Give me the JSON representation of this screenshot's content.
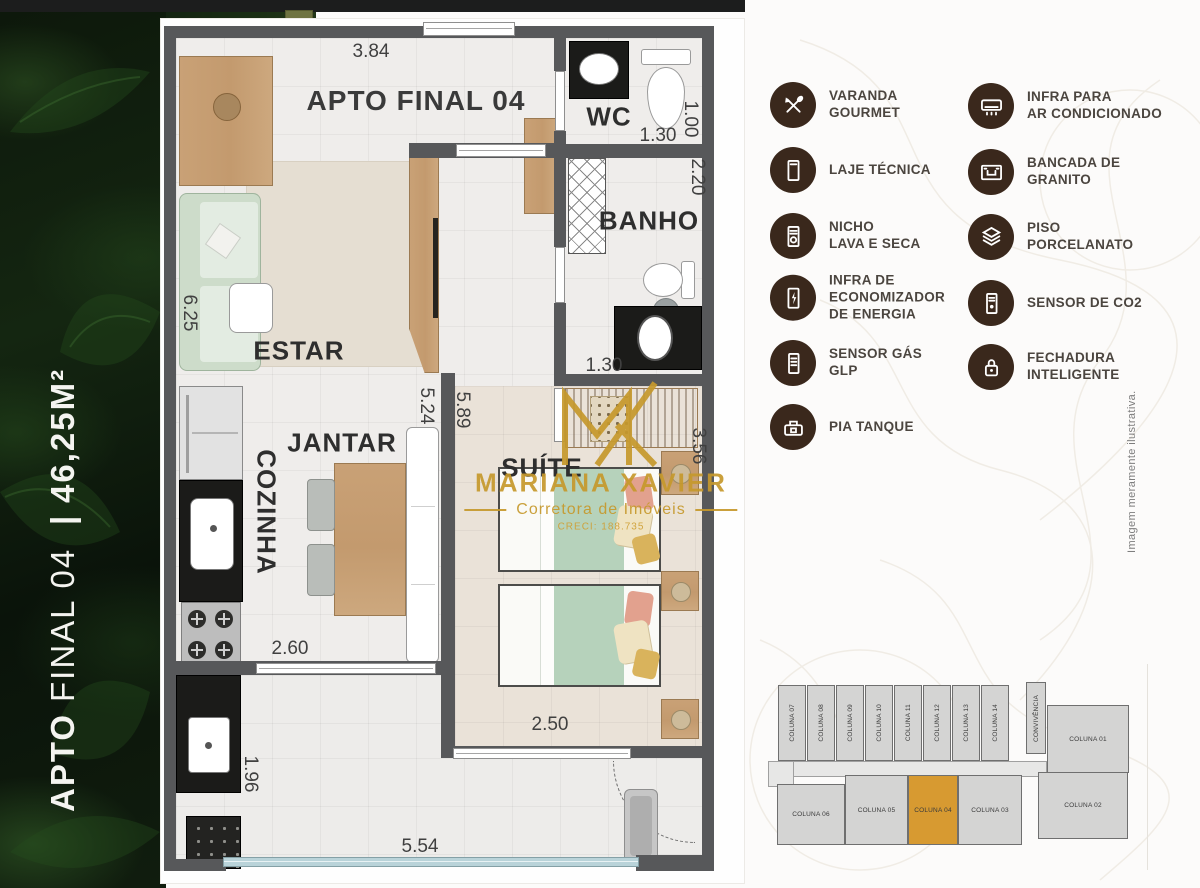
{
  "left_panel": {
    "apto": "APTO",
    "final": "FINAL 04",
    "separator": "|",
    "area": "46,25M²"
  },
  "floorplan": {
    "title": "APTO FINAL 04",
    "rooms": {
      "estar": "ESTAR",
      "jantar": "JANTAR",
      "cozinha": "COZINHA",
      "wc": "WC",
      "banho": "BANHO",
      "suite": "SUÍTE"
    },
    "dimensions": {
      "top_width": "3.84",
      "wc_width": "1.30",
      "wc_height": "1.00",
      "banho_height": "2.20",
      "banho_width": "1.30",
      "estar_height": "6.25",
      "divider_left": "5.24",
      "divider_right": "5.89",
      "suite_height": "3.56",
      "cozinha_width": "2.60",
      "suite_width": "2.50",
      "varanda_height": "1.96",
      "bottom_width": "5.54"
    }
  },
  "watermark": {
    "name": "MARIANA XAVIER",
    "subtitle": "Corretora de Imóveis",
    "creci": "CRECI: 188.735"
  },
  "legend": {
    "columns": [
      {
        "items": [
          {
            "icon": "varanda-gourmet-icon",
            "lines": [
              "VARANDA",
              "GOURMET"
            ]
          },
          {
            "icon": "laje-tecnica-icon",
            "lines": [
              "LAJE TÉCNICA"
            ]
          },
          {
            "icon": "nicho-lava-seca-icon",
            "lines": [
              "NICHO",
              "LAVA E SECA"
            ]
          },
          {
            "icon": "economizador-energia-icon",
            "lines": [
              "INFRA DE",
              "ECONOMIZADOR",
              "DE ENERGIA"
            ]
          },
          {
            "icon": "sensor-gas-glp-icon",
            "lines": [
              "SENSOR GÁS",
              "GLP"
            ]
          },
          {
            "icon": "pia-tanque-icon",
            "lines": [
              "PIA TANQUE"
            ]
          }
        ]
      },
      {
        "items": [
          {
            "icon": "ar-condicionado-icon",
            "lines": [
              "INFRA PARA",
              "AR CONDICIONADO"
            ]
          },
          {
            "icon": "bancada-granito-icon",
            "lines": [
              "BANCADA DE",
              "GRANITO"
            ]
          },
          {
            "icon": "piso-porcelanato-icon",
            "lines": [
              "PISO",
              "PORCELANATO"
            ]
          },
          {
            "icon": "sensor-co2-icon",
            "lines": [
              "SENSOR DE CO2"
            ]
          },
          {
            "icon": "fechadura-inteligente-icon",
            "lines": [
              "FECHADURA",
              "INTELIGENTE"
            ]
          }
        ]
      }
    ]
  },
  "disclaimer": "Imagem meramente ilustrativa.",
  "building_key": {
    "vertical_units": [
      "COLUNA 07",
      "COLUNA 08",
      "COLUNA 09",
      "COLUNA 10",
      "COLUNA 11",
      "COLUNA 12",
      "COLUNA 13",
      "COLUNA 14"
    ],
    "convivencia": "CONVIVÊNCIA",
    "right_top_unit": "COLUNA 01",
    "bottom_units": [
      "COLUNA 06",
      "COLUNA 05",
      "COLUNA 04",
      "COLUNA 03"
    ],
    "right_bottom_unit": "COLUNA 02",
    "highlighted_unit": "COLUNA 04",
    "highlight_color": "#d79a31"
  }
}
